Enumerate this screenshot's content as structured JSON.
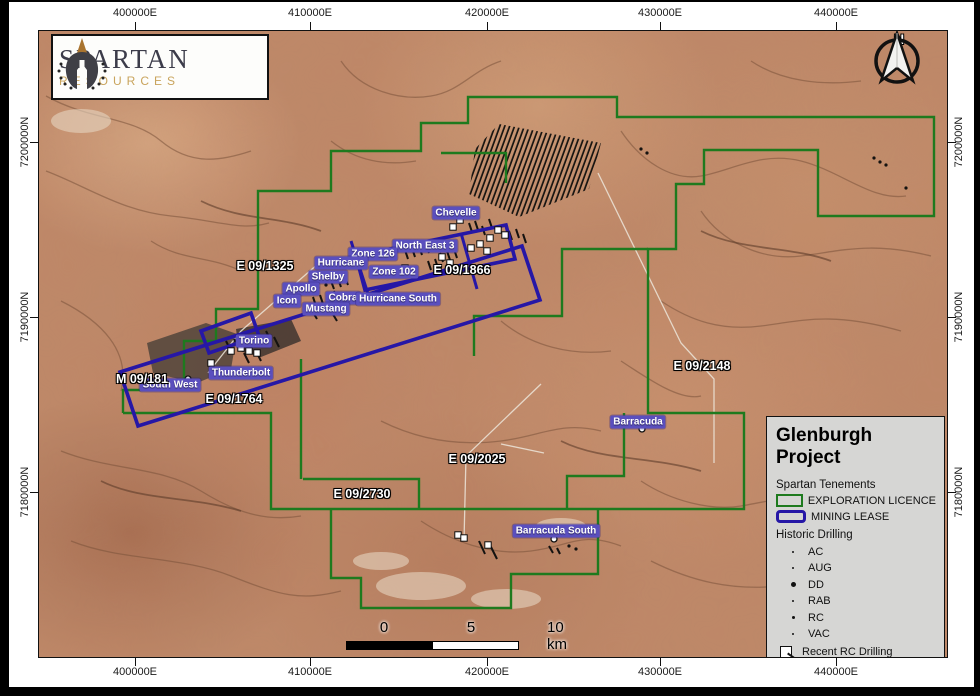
{
  "logo": {
    "name": "SPARTAN",
    "sub": "RESOURCES"
  },
  "north": {
    "label": "N"
  },
  "grid": {
    "top": [
      {
        "t": "400000E",
        "x": 135
      },
      {
        "t": "410000E",
        "x": 310
      },
      {
        "t": "420000E",
        "x": 487
      },
      {
        "t": "430000E",
        "x": 660
      },
      {
        "t": "440000E",
        "x": 836
      }
    ],
    "bottom": [
      {
        "t": "400000E",
        "x": 135
      },
      {
        "t": "410000E",
        "x": 310
      },
      {
        "t": "420000E",
        "x": 487
      },
      {
        "t": "430000E",
        "x": 660
      },
      {
        "t": "440000E",
        "x": 836
      }
    ],
    "left": [
      {
        "t": "7200000N",
        "y": 142
      },
      {
        "t": "7190000N",
        "y": 317
      },
      {
        "t": "7180000N",
        "y": 492
      }
    ],
    "right": [
      {
        "t": "7200000N",
        "y": 142
      },
      {
        "t": "7190000N",
        "y": 317
      },
      {
        "t": "7180000N",
        "y": 492
      }
    ]
  },
  "scalebar": {
    "zero": "0",
    "five": "5",
    "ten": "10 km"
  },
  "legend": {
    "title": "Glenburgh Project",
    "tenements_heading": "Spartan Tenements",
    "tenement_items": [
      {
        "label": "EXPLORATION LICENCE",
        "color": "#1e7a1e",
        "thick": 2.5,
        "radius": 0
      },
      {
        "label": "MINING LEASE",
        "color": "#2617a6",
        "thick": 3.5,
        "radius": 4
      }
    ],
    "drilling_heading": "Historic Drilling",
    "drilling_items": [
      {
        "label": "AC",
        "size": 2
      },
      {
        "label": "AUG",
        "size": 2
      },
      {
        "label": "DD",
        "size": 5
      },
      {
        "label": "RAB",
        "size": 2
      },
      {
        "label": "RC",
        "size": 3
      },
      {
        "label": "VAC",
        "size": 2
      }
    ],
    "recent_label": "Recent RC Drilling"
  },
  "map": {
    "tenement_labels": [
      {
        "text": "E 09/1325",
        "x": 264,
        "y": 265
      },
      {
        "text": "E 09/1866",
        "x": 461,
        "y": 269
      },
      {
        "text": "E 09/2148",
        "x": 701,
        "y": 365
      },
      {
        "text": "E 09/2025",
        "x": 476,
        "y": 458
      },
      {
        "text": "E 09/2730",
        "x": 361,
        "y": 493
      },
      {
        "text": "E 09/1764",
        "x": 233,
        "y": 398
      },
      {
        "text": "M 09/181",
        "x": 141,
        "y": 378
      }
    ],
    "prospect_labels": [
      {
        "text": "Chevelle",
        "x": 455,
        "y": 212
      },
      {
        "text": "North East 3",
        "x": 424,
        "y": 245
      },
      {
        "text": "Zone 126",
        "x": 372,
        "y": 253
      },
      {
        "text": "Hurricane",
        "x": 340,
        "y": 262
      },
      {
        "text": "Zone 102",
        "x": 393,
        "y": 271
      },
      {
        "text": "Shelby",
        "x": 327,
        "y": 276
      },
      {
        "text": "Apollo",
        "x": 300,
        "y": 288
      },
      {
        "text": "Cobra",
        "x": 342,
        "y": 297
      },
      {
        "text": "Icon",
        "x": 286,
        "y": 300
      },
      {
        "text": "Mustang",
        "x": 325,
        "y": 308
      },
      {
        "text": "Hurricane South",
        "x": 397,
        "y": 298
      },
      {
        "text": "Torino",
        "x": 253,
        "y": 340
      },
      {
        "text": "Thunderbolt",
        "x": 240,
        "y": 372
      },
      {
        "text": "South West",
        "x": 169,
        "y": 384
      },
      {
        "text": "Barracuda",
        "x": 637,
        "y": 421
      },
      {
        "text": "Barracuda South",
        "x": 555,
        "y": 530
      }
    ],
    "colors": {
      "exploration": "#1e7a1e",
      "mining": "#2617a6",
      "road": "#ece5d9",
      "vein": "#7a523b",
      "vein_dark": "#5d3c2a"
    },
    "geo": {
      "exploration_paths": [
        "122,412 122,389 183,389 183,340 215,340 215,308 257,308 257,190 330,190 330,150 420,150 420,122 467,122 467,96 616,96 616,116 933,116 933,215 817,215 817,149 703,149 703,183 675,183 675,248 647,248 647,412 743,412 743,508 270,508 270,412 122,412",
        "647,248 561,248 561,315 473,315 473,355",
        "440,152 505,152 505,182",
        "300,358 300,478",
        "302,478 418,478 418,508",
        "623,412 623,475 566,475 566,508",
        "330,508 330,577 360,577 360,607 510,607 510,573 597,573 597,508"
      ],
      "mining_polys": [
        "119,371 521,245 539,299 137,425",
        "355,255 505,224 514,258 364,289",
        "200,330 250,312 258,335 208,352"
      ],
      "mining_lines": [
        "350,240 368,296",
        "460,232 476,288"
      ],
      "hatch": "498,123 600,142 588,188 518,216 468,193 474,148",
      "roads": [
        "M597,172 L680,342 L713,378 L713,462",
        "M318,262 L240,330 L207,372",
        "M540,383 L465,455 L463,540",
        "M500,443 L543,452"
      ],
      "veins": [
        "M45,95 C90,120 130,115 160,140 S220,160 250,150",
        "M45,170 C85,185 120,210 170,215 S240,230 268,222",
        "M340,60 C360,90 400,100 430,95 S470,70 500,60",
        "M620,130 C640,160 670,180 700,175 S760,150 800,160 C840,170 870,200 905,195",
        "M700,210 C720,240 760,260 800,255 S870,240 930,255",
        "M660,300 C690,320 720,330 760,325 S830,310 900,330",
        "M620,360 C650,380 680,400 700,395",
        "M60,300 C100,320 130,350 120,390",
        "M60,450 C110,470 160,465 200,490 S270,520 300,515",
        "M70,540 C120,560 180,555 230,575 S300,600 340,590",
        "M380,420 C420,440 460,445 500,440 S560,420 600,430",
        "M420,520 C450,540 490,555 530,550 S580,530 620,545",
        "M640,480 C670,500 710,510 740,505 S800,490 850,505 S910,520 940,515",
        "M650,560 C690,580 730,590 780,585 S860,570 920,585",
        "M150,240 C180,260 210,255 240,270",
        "M500,320 C530,345 570,355 610,350",
        "M750,60 C780,80 820,85 860,80",
        "M330,140 C355,160 385,165 415,160"
      ],
      "veins_dark": [
        "M200,200 C240,220 280,215 320,230",
        "M700,230 C740,250 790,245 830,260",
        "M100,480 C140,500 190,495 240,510",
        "M560,440 C600,460 650,455 700,470"
      ],
      "pale_patches": [
        [
          420,
          585,
          45,
          14
        ],
        [
          505,
          598,
          35,
          10
        ],
        [
          560,
          525,
          25,
          8
        ],
        [
          80,
          120,
          30,
          12
        ],
        [
          380,
          560,
          28,
          9
        ]
      ],
      "dark_areas": [
        {
          "pts": "146,342 205,322 236,333 230,368 196,382 152,372",
          "fill": "#4a4038",
          "op": 0.8
        },
        {
          "pts": "235,328 290,318 300,340 260,356 238,350",
          "fill": "#2e2a28",
          "op": 0.75
        }
      ],
      "drill_lines": [
        [
          404,
          249,
          407,
          258
        ],
        [
          411,
          247,
          414,
          256
        ],
        [
          418,
          245,
          421,
          254
        ],
        [
          425,
          243,
          428,
          252
        ],
        [
          432,
          241,
          435,
          250
        ],
        [
          439,
          252,
          442,
          261
        ],
        [
          446,
          250,
          449,
          259
        ],
        [
          453,
          248,
          456,
          257
        ],
        [
          427,
          260,
          430,
          269
        ],
        [
          434,
          258,
          437,
          267
        ],
        [
          312,
          296,
          315,
          305
        ],
        [
          319,
          294,
          322,
          303
        ],
        [
          326,
          292,
          329,
          301
        ],
        [
          333,
          290,
          336,
          299
        ],
        [
          340,
          296,
          343,
          305
        ],
        [
          347,
          294,
          350,
          303
        ],
        [
          310,
          308,
          316,
          318
        ],
        [
          330,
          310,
          336,
          320
        ],
        [
          330,
          280,
          333,
          288
        ],
        [
          337,
          278,
          340,
          286
        ],
        [
          344,
          276,
          347,
          284
        ],
        [
          225,
          340,
          230,
          350
        ],
        [
          233,
          338,
          238,
          348
        ],
        [
          241,
          336,
          246,
          346
        ],
        [
          249,
          334,
          254,
          344
        ],
        [
          257,
          332,
          262,
          342
        ],
        [
          265,
          330,
          270,
          340
        ],
        [
          273,
          336,
          278,
          346
        ],
        [
          255,
          350,
          260,
          360
        ],
        [
          243,
          352,
          248,
          362
        ],
        [
          468,
          222,
          471,
          231
        ],
        [
          474,
          220,
          477,
          229
        ],
        [
          481,
          225,
          484,
          234
        ],
        [
          488,
          218,
          491,
          227
        ],
        [
          508,
          230,
          511,
          239
        ],
        [
          515,
          228,
          518,
          237
        ],
        [
          522,
          233,
          525,
          242
        ],
        [
          478,
          540,
          484,
          553
        ],
        [
          490,
          546,
          496,
          558
        ],
        [
          548,
          545,
          552,
          552
        ],
        [
          556,
          547,
          559,
          553
        ]
      ],
      "squares": [
        [
          459,
          219
        ],
        [
          452,
          226
        ],
        [
          479,
          243
        ],
        [
          486,
          250
        ],
        [
          470,
          247
        ],
        [
          441,
          256
        ],
        [
          449,
          262
        ],
        [
          404,
          267
        ],
        [
          497,
          229
        ],
        [
          504,
          234
        ],
        [
          489,
          237
        ],
        [
          240,
          347
        ],
        [
          248,
          350
        ],
        [
          256,
          352
        ],
        [
          230,
          350
        ],
        [
          210,
          362
        ],
        [
          457,
          534
        ],
        [
          463,
          537
        ],
        [
          487,
          544
        ]
      ],
      "circles": [
        [
          187,
          378
        ],
        [
          641,
          428
        ],
        [
          553,
          538
        ]
      ],
      "dots": [
        [
          873,
          157
        ],
        [
          879,
          161
        ],
        [
          885,
          164
        ],
        [
          905,
          187
        ],
        [
          640,
          148
        ],
        [
          646,
          152
        ],
        [
          317,
          287
        ],
        [
          309,
          290
        ],
        [
          301,
          293
        ],
        [
          293,
          297
        ],
        [
          285,
          300
        ],
        [
          325,
          284
        ],
        [
          568,
          545
        ],
        [
          575,
          548
        ]
      ]
    }
  }
}
